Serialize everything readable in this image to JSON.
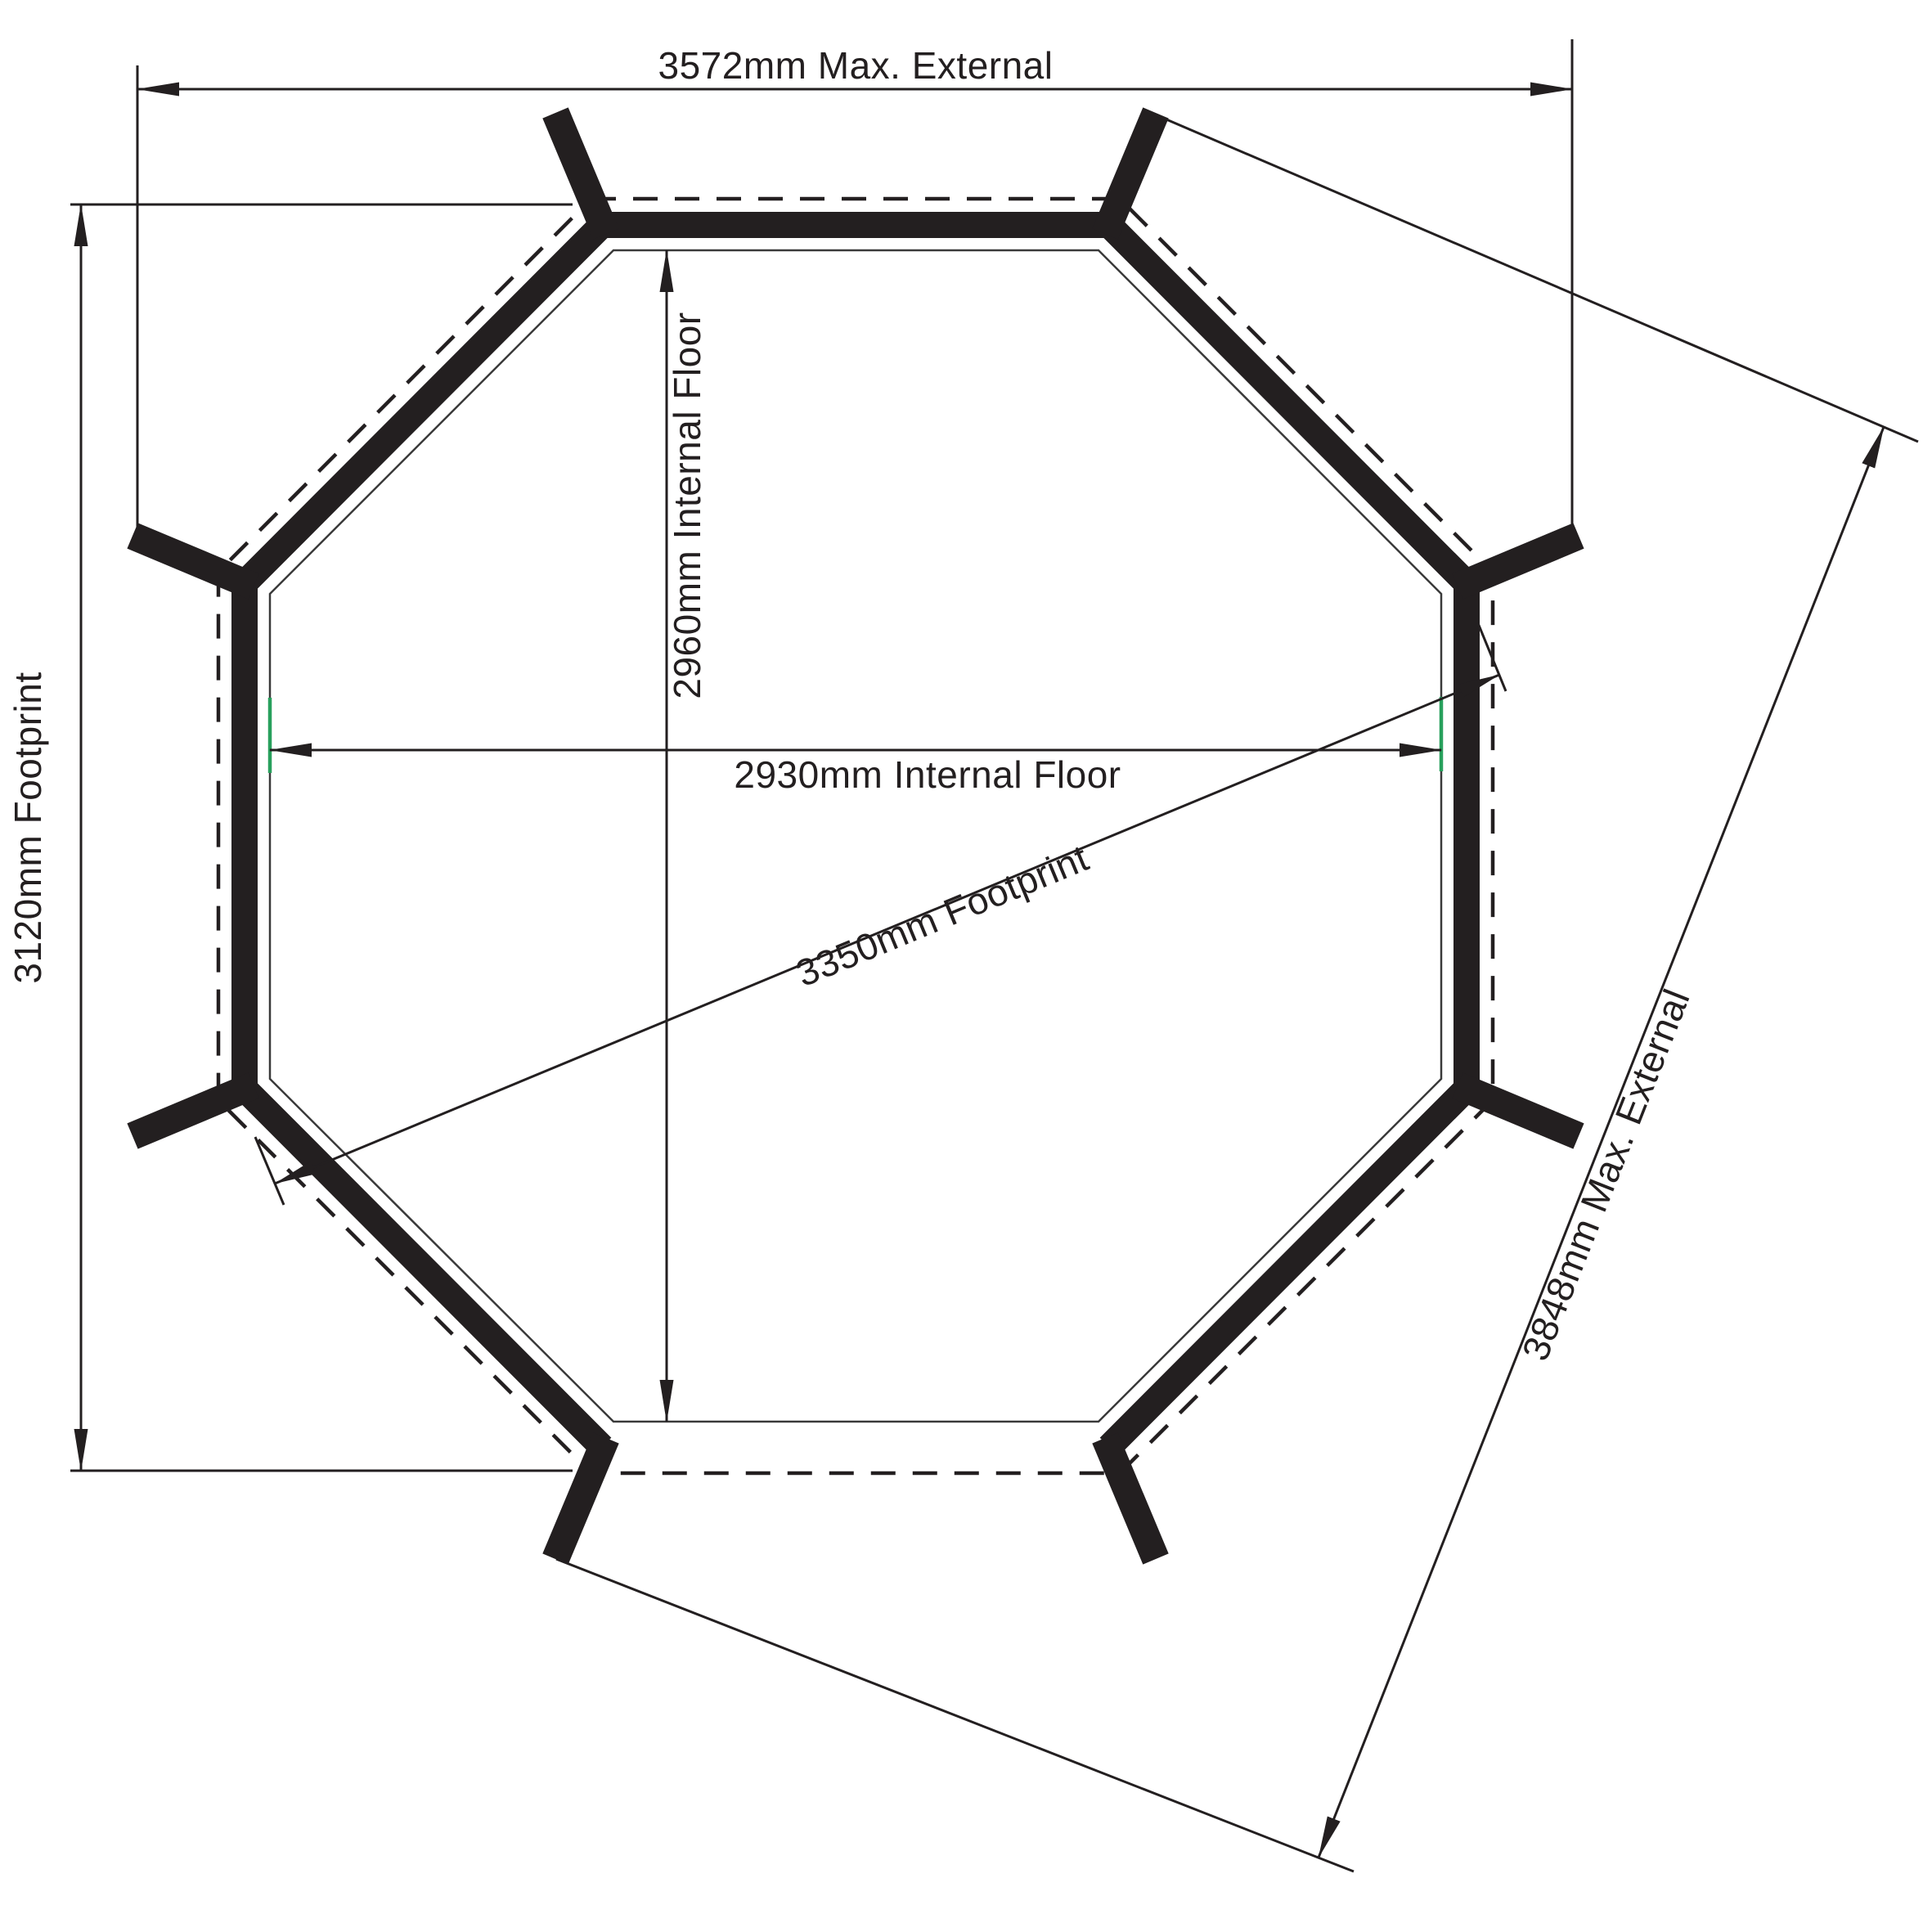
{
  "colors": {
    "line": "#231f20",
    "background": "#ffffff",
    "accent_green": "#28a05c"
  },
  "dimensions": {
    "top_external_width": {
      "label": "3572mm Max. External"
    },
    "left_footprint_height": {
      "label": "3120mm Footprint"
    },
    "internal_floor_width": {
      "label": "2930mm Internal Floor"
    },
    "internal_floor_height": {
      "label": "2960mm Internal Floor"
    },
    "footprint_diagonal": {
      "label": "3350mm Footprint"
    },
    "external_diagonal": {
      "label": "3848mm Max. External"
    }
  }
}
